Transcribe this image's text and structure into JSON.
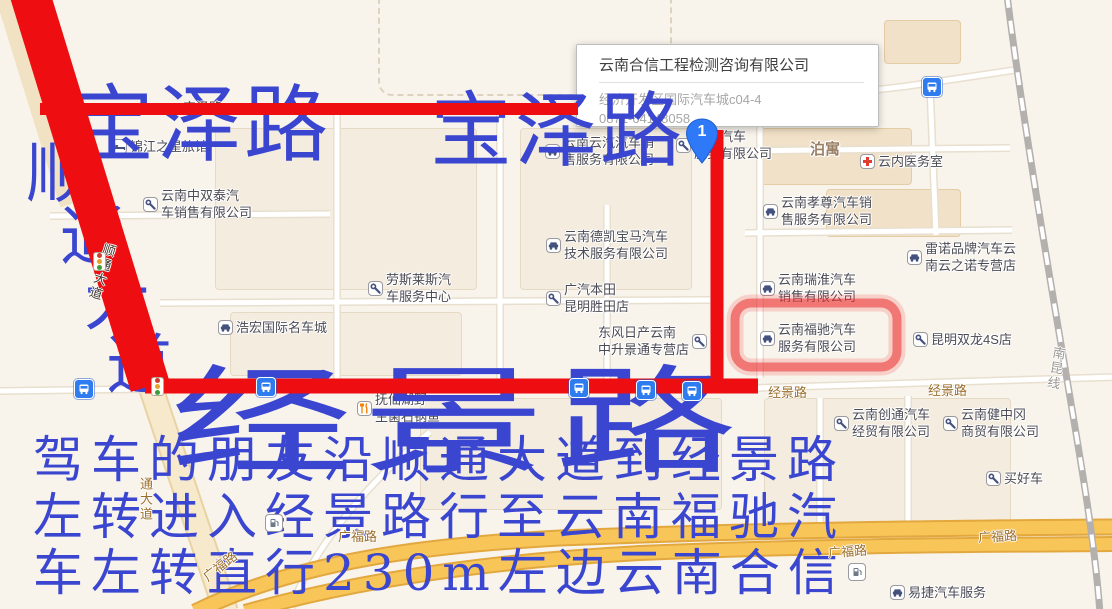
{
  "colors": {
    "annotation_blue": "#3a46d0",
    "route_red": "#ee0d10",
    "highlight_red": "rgba(237,45,45,0.55)",
    "road_yellow": "#f8c658",
    "road_label_brown": "#9c6f2d",
    "bus_icon_blue": "#2e7cf0",
    "marker_blue": "#2e79f7"
  },
  "annotations": {
    "road_name_top_left": "宝泽路",
    "road_name_top_right": "宝泽路",
    "road_name_diagonal_chars": [
      "顺",
      "通",
      "大",
      "道"
    ],
    "road_name_bottom_big": "经景路",
    "directions_line1": "驾车的朋友沿顺通大道到经景路",
    "directions_line2": "左转进入经景路行至云南福驰汽",
    "directions_line3": "车左转直行230m左边云南合信"
  },
  "info_window": {
    "title": "云南合信工程检测咨询有限公司",
    "address": "经济开发区国际汽车城c04-4",
    "phone": "0871-64148058"
  },
  "marker": {
    "label": "1"
  },
  "pois": [
    {
      "icon": "bed",
      "x": 112,
      "y": 138,
      "lines": [
        "锦江之星旅馆"
      ]
    },
    {
      "icon": "wrench",
      "x": 143,
      "y": 187,
      "lines": [
        "云南中双泰汽",
        "车销售有限公司"
      ]
    },
    {
      "icon": "car",
      "x": 545,
      "y": 134,
      "lines": [
        "云南云汽汽车销",
        "售服务有限公司"
      ]
    },
    {
      "icon": "wrench",
      "x": 676,
      "y": 128,
      "lines": [
        "经华汽车",
        "服务有限公司"
      ]
    },
    {
      "icon": "cross",
      "x": 860,
      "y": 153,
      "lines": [
        "云内医务室"
      ]
    },
    {
      "icon": "car",
      "x": 763,
      "y": 194,
      "lines": [
        "云南孝尊汽车销",
        "售服务有限公司"
      ]
    },
    {
      "icon": "car",
      "x": 907,
      "y": 240,
      "lines": [
        "雷诺品牌汽车云",
        "南云之诺专营店"
      ]
    },
    {
      "icon": "car",
      "x": 546,
      "y": 228,
      "lines": [
        "云南德凯宝马汽车",
        "技术服务有限公司"
      ]
    },
    {
      "icon": "wrench",
      "x": 368,
      "y": 271,
      "lines": [
        "劳斯莱斯汽",
        "车服务中心"
      ]
    },
    {
      "icon": "wrench",
      "x": 546,
      "y": 281,
      "lines": [
        "广汽本田",
        "昆明胜田店"
      ]
    },
    {
      "icon": "car",
      "x": 218,
      "y": 319,
      "lines": [
        "浩宏国际名车城"
      ]
    },
    {
      "icon": "wrench",
      "x": 598,
      "y": 324,
      "lines": [
        "东风日产云南",
        "中升景通专营店"
      ],
      "icon_side": "right"
    },
    {
      "icon": "car",
      "x": 760,
      "y": 271,
      "lines": [
        "云南瑞淮汽车",
        "销售有限公司"
      ]
    },
    {
      "icon": "car",
      "x": 760,
      "y": 321,
      "lines": [
        "云南福驰汽车",
        "服务有限公司"
      ]
    },
    {
      "icon": "wrench",
      "x": 913,
      "y": 331,
      "lines": [
        "昆明双龙4S店"
      ]
    },
    {
      "icon": "fork",
      "x": 357,
      "y": 391,
      "lines": [
        "抚仙湖野",
        "生菌石锅鱼"
      ]
    },
    {
      "icon": "wrench",
      "x": 834,
      "y": 406,
      "lines": [
        "云南创通汽车",
        "经贸有限公司"
      ]
    },
    {
      "icon": "wrench",
      "x": 943,
      "y": 406,
      "lines": [
        "云南健中冈",
        "商贸有限公司"
      ]
    },
    {
      "icon": "wrench",
      "x": 986,
      "y": 470,
      "lines": [
        "买好车"
      ]
    },
    {
      "icon": "car",
      "x": 890,
      "y": 584,
      "lines": [
        "易捷汽车服务"
      ]
    },
    {
      "icon": "none",
      "x": 810,
      "y": 141,
      "lines": [
        "泊寓"
      ],
      "placename": true
    }
  ],
  "road_labels": [
    {
      "text": "经景路",
      "x": 768,
      "y": 382
    },
    {
      "text": "经景路",
      "x": 928,
      "y": 380
    },
    {
      "text": "广福路",
      "x": 338,
      "y": 526
    },
    {
      "text": "广福路",
      "x": 828,
      "y": 541,
      "rot": -4
    },
    {
      "text": "广福路",
      "x": 978,
      "y": 526,
      "rot": -3
    },
    {
      "text": "广福路",
      "x": 200,
      "y": 556,
      "rot": -38
    },
    {
      "text": "通大道",
      "x": 136,
      "y": 477,
      "vert": true
    },
    {
      "text": "宝泽路",
      "x": 183,
      "y": 97,
      "color": "#4a443c",
      "under_route": true
    },
    {
      "text": "顺通大道",
      "x": 92,
      "y": 242,
      "vert": true,
      "rot": 17,
      "color": "#43392f"
    },
    {
      "text": "南昆线",
      "x": 1046,
      "y": 346,
      "vert": true,
      "rot": 10,
      "color": "#9b9893"
    }
  ],
  "transit_icons": [
    {
      "type": "bus",
      "x": 74,
      "y": 379
    },
    {
      "type": "bus",
      "x": 256,
      "y": 377
    },
    {
      "type": "bus",
      "x": 569,
      "y": 378
    },
    {
      "type": "bus",
      "x": 636,
      "y": 380
    },
    {
      "type": "bus",
      "x": 682,
      "y": 381
    },
    {
      "type": "bus",
      "x": 922,
      "y": 77
    },
    {
      "type": "traffic",
      "x": 151,
      "y": 377
    },
    {
      "type": "traffic",
      "x": 93,
      "y": 252
    },
    {
      "type": "gas",
      "x": 265,
      "y": 514
    },
    {
      "type": "gas",
      "x": 848,
      "y": 563
    }
  ]
}
